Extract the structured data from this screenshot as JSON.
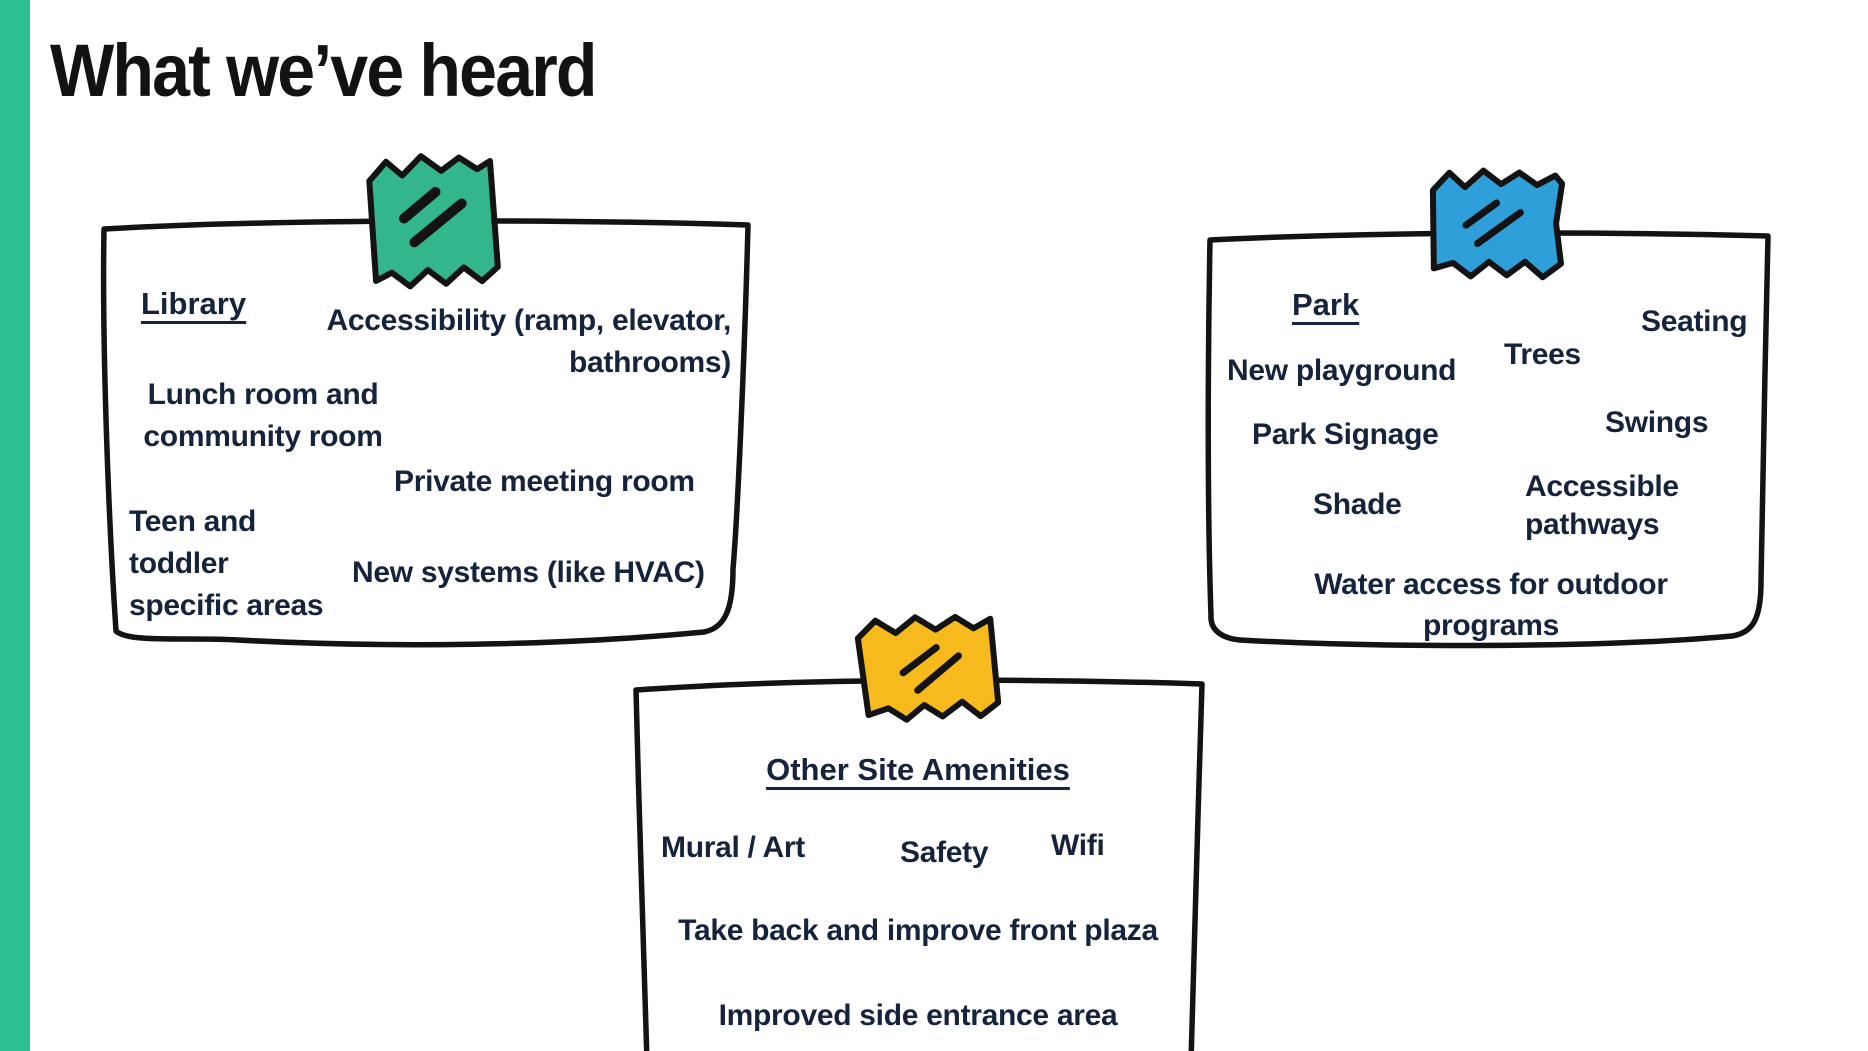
{
  "page": {
    "title": "What we’ve heard"
  },
  "theme": {
    "accent_bar_color": "#2BBE92",
    "title_color": "#121212",
    "card_text_color": "#16233C",
    "card_border_color": "#131313",
    "card_fill_color": "#FFFFFF",
    "tape_green": "#33B58D",
    "tape_blue": "#2E9FD9",
    "tape_yellow": "#F6BA1C",
    "tape_mark_color": "#131313"
  },
  "cards": [
    {
      "id": "library",
      "heading": "Library",
      "items": [
        "Accessibility (ramp, elevator,\nbathrooms)",
        "Lunch room and\ncommunity room",
        "Private meeting room",
        "Teen and\ntoddler\nspecific areas",
        "New systems (like HVAC)"
      ]
    },
    {
      "id": "park",
      "heading": "Park",
      "items": [
        "Seating",
        "New playground",
        "Trees",
        "Park Signage",
        "Swings",
        "Shade",
        "Accessible\npathways",
        "Water access for outdoor\nprograms"
      ]
    },
    {
      "id": "other-site-amenities",
      "heading": "Other Site Amenities",
      "items": [
        "Mural / Art",
        "Safety",
        "Wifi",
        "Take back and improve front plaza",
        "Improved side entrance area"
      ]
    }
  ]
}
